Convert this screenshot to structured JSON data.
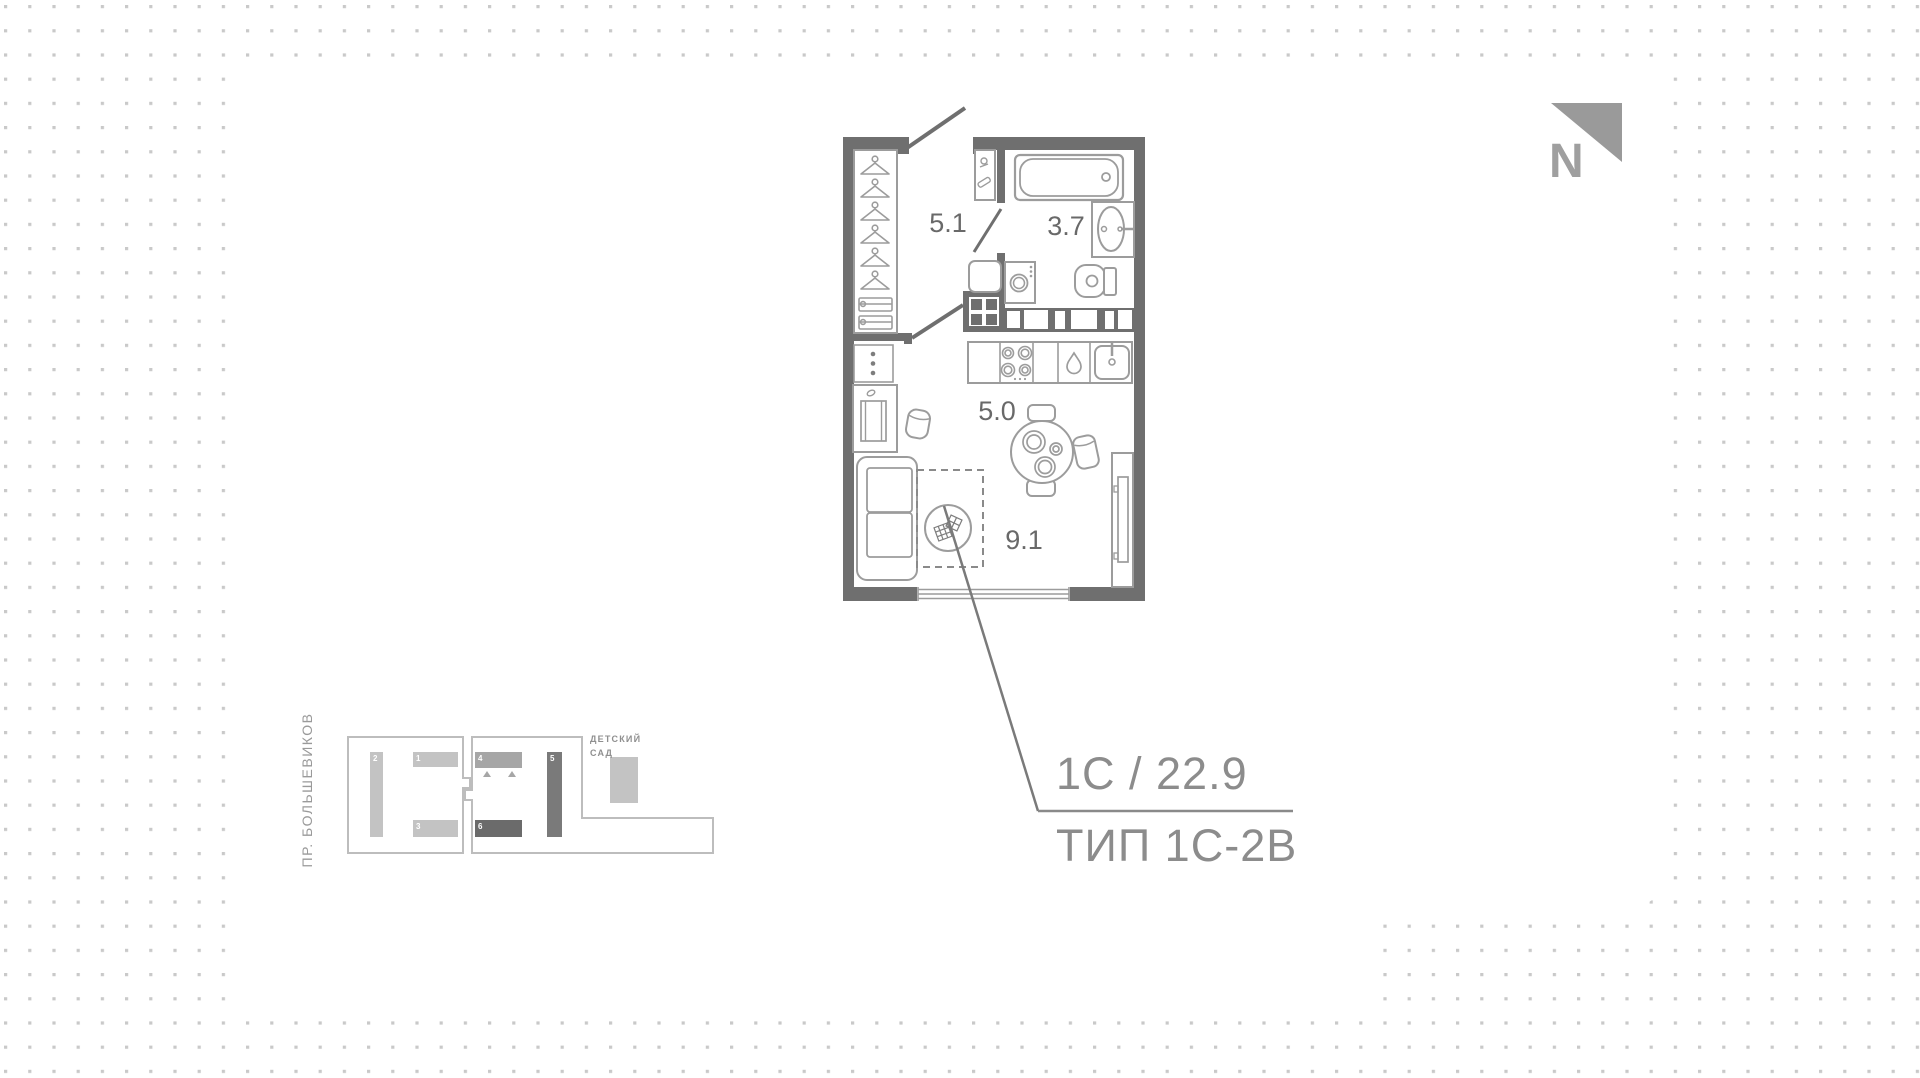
{
  "north": {
    "label": "N",
    "color": "#9a9a9a"
  },
  "plan": {
    "rooms": {
      "hall": {
        "name": "hallway",
        "area": "5.1"
      },
      "bath": {
        "name": "bathroom",
        "area": "3.7"
      },
      "kitchen": {
        "name": "kitchen",
        "area": "5.0"
      },
      "living": {
        "name": "living-room",
        "area": "9.1"
      }
    },
    "total_area": "22.9"
  },
  "callout": {
    "code": "1С / 22.9",
    "type": "ТИП 1С-2В"
  },
  "site_map": {
    "street": "ПР. БОЛЬШЕВИКОВ",
    "kindergarten": "ДЕТСКИЙ\nСАД",
    "buildings": [
      {
        "label": "1",
        "tone": "light"
      },
      {
        "label": "2",
        "tone": "light"
      },
      {
        "label": "3",
        "tone": "light"
      },
      {
        "label": "4",
        "tone": "medium",
        "current": true
      },
      {
        "label": "5",
        "tone": "dark"
      },
      {
        "label": "6",
        "tone": "dark"
      }
    ]
  },
  "colors": {
    "background_dot": "#c9c9c9",
    "card": "#ffffff",
    "wall": "#6f6f6f",
    "furniture_stroke": "#9c9c9c",
    "room_number": "#696969",
    "callout_text": "#8c8c8c",
    "leader_line": "#7a7a7a",
    "building_light": "#c3c3c3",
    "building_medium": "#a6a6a6",
    "building_dark_5": "#7a7a7a",
    "building_dark_6": "#6b6b6b",
    "lot_outline": "#bdbdbd",
    "north": "#9a9a9a"
  }
}
